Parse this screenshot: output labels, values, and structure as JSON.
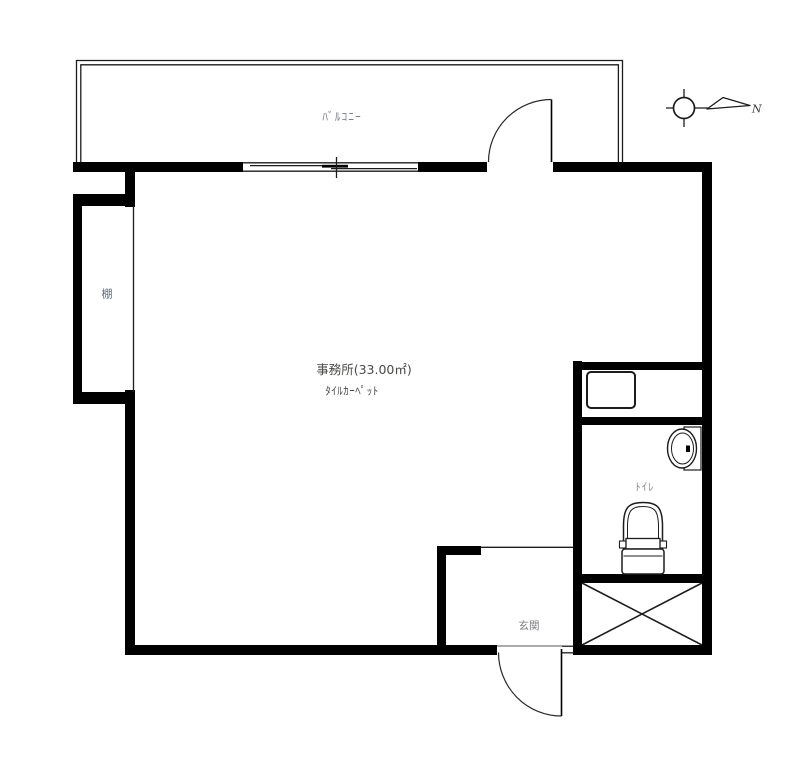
{
  "floorplan": {
    "rooms": {
      "balcony": {
        "label": "ﾊﾞﾙｺﾆｰ"
      },
      "office": {
        "label": "事務所(33.00㎡)",
        "floor_note": "ﾀｲﾙｶｰﾍﾟｯﾄ"
      },
      "shelf": {
        "label": "棚"
      },
      "toilet": {
        "label": "ﾄｲﾚ"
      },
      "entrance": {
        "label": "玄関"
      }
    },
    "compass": {
      "north_label": "N"
    },
    "colors": {
      "wall": "#000000",
      "line": "#1c1c1c",
      "label_gray": "#80838c",
      "label_blue_gray": "#5f6e80",
      "label_dark": "#4a4a48",
      "background": "#ffffff"
    }
  }
}
